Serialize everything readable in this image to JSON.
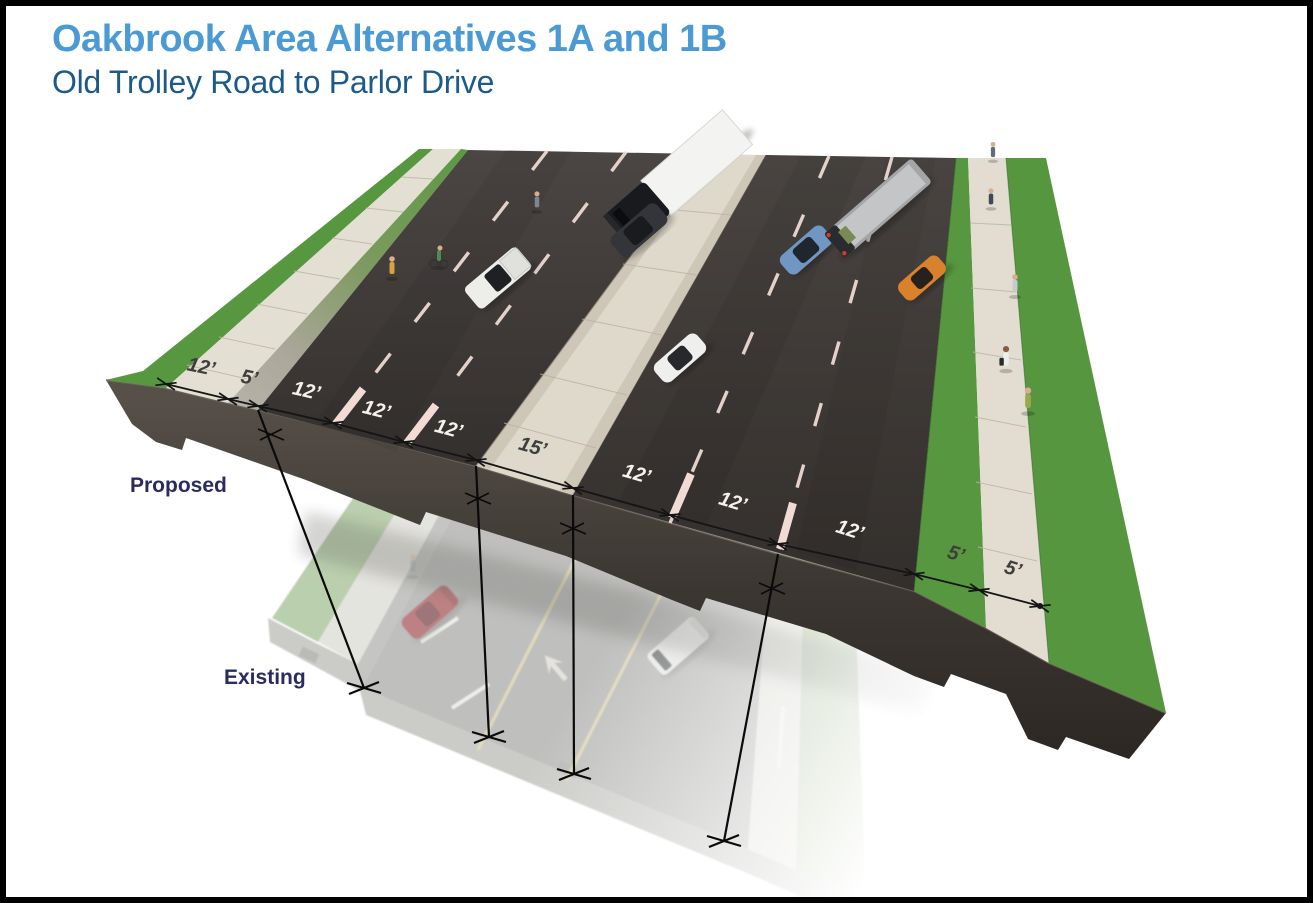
{
  "header": {
    "title": "Oakbrook Area Alternatives 1A and 1B",
    "subtitle": "Old Trolley Road to Parlor Drive"
  },
  "figure": {
    "proposed_label": "Proposed",
    "existing_label": "Existing",
    "dims": [
      "12’",
      "5’",
      "12’",
      "12’",
      "12’",
      "15’",
      "12’",
      "12’",
      "12’",
      "5’",
      "5’"
    ]
  },
  "colors": {
    "title_blue": "#4B9AD4",
    "subtitle_blue": "#1D5A89",
    "label_navy": "#2A2B5E",
    "grass_green": "#579740",
    "asphalt_dark": "#3E3936",
    "concrete": "#E3DED2",
    "lane_marking_pink": "#EDD9D2",
    "border": "#000000"
  }
}
